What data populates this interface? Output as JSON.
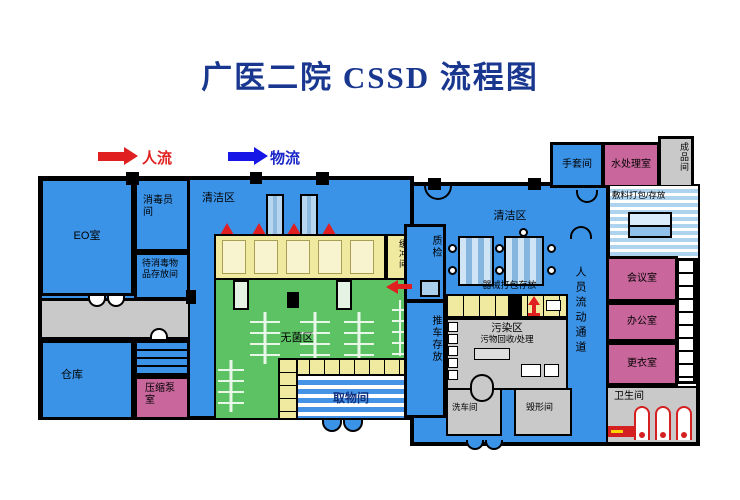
{
  "title": "广医二院 CSSD 流程图",
  "legend": {
    "people_flow": "人流",
    "material_flow": "物流"
  },
  "colors": {
    "title_blue": "#1a3790",
    "room_blue": "#3b93e8",
    "room_pink": "#c9679c",
    "sterile_green": "#5dc263",
    "band_yellow": "#f0e9a0",
    "zone_gray": "#c9c9c9",
    "flow_red": "#e02020",
    "flow_blue": "#1616e6"
  },
  "rooms": {
    "eo": "EO室",
    "disinfect_staff": "消毒员间",
    "pending_storage": "待消毒物品存放间",
    "warehouse": "仓库",
    "pump": "压缩泵室",
    "clean_left": "清洁区",
    "buffer": "缓冲间",
    "sterile": "无菌区",
    "pickup": "取物间",
    "qc": "质检",
    "cart": "推车存放",
    "clean_right": "清洁区",
    "instrument": "器械打包存放",
    "dirty": "污染区",
    "dirty_sub": "污物回收/处理",
    "wash": "洗车间",
    "destroy": "毁形间",
    "corridor": "人员流动通道",
    "glove": "手套间",
    "water": "水处理室",
    "product": "成品间",
    "dressing": "敷料打包/存放",
    "meeting": "会议室",
    "office": "办公室",
    "changing": "更衣室",
    "toilet": "卫生间"
  }
}
